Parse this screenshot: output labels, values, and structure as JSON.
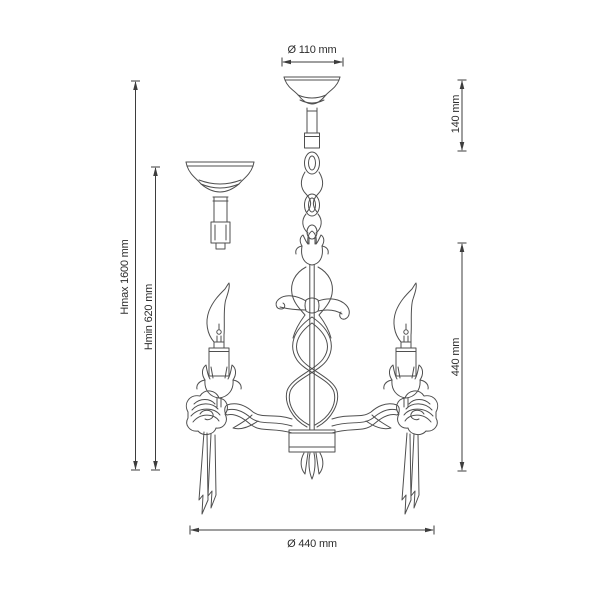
{
  "page": {
    "background": "#ffffff",
    "line_color": "#4f4f4f",
    "dimension_color": "#3d3d3d",
    "text_color": "#2d2d2d"
  },
  "drawing": {
    "parts": [
      "ceiling-canopy",
      "hanging-chain",
      "flush-mount-canopy",
      "ornate-center-column",
      "ribbon-bow",
      "twisted-helix-stem",
      "hub-cylinder",
      "leaf-finial",
      "left-arm",
      "right-arm",
      "candle-bulbs",
      "tulip-bobeches",
      "rose-ornaments",
      "ribbon-tails"
    ]
  },
  "dimensions": [
    {
      "name": "canopy-diameter",
      "label": "Ø 110 mm",
      "value_mm": 110,
      "type": "diameter",
      "orientation": "horizontal"
    },
    {
      "name": "canopy-height",
      "label": "140 mm",
      "value_mm": 140,
      "type": "height",
      "orientation": "vertical"
    },
    {
      "name": "max-height",
      "label": "Hmax 1600 mm",
      "value_mm": 1600,
      "type": "height",
      "orientation": "vertical"
    },
    {
      "name": "min-height",
      "label": "Hmin 620 mm",
      "value_mm": 620,
      "type": "height",
      "orientation": "vertical"
    },
    {
      "name": "fixture-height",
      "label": "440 mm",
      "value_mm": 440,
      "type": "height",
      "orientation": "vertical"
    },
    {
      "name": "fixture-diameter",
      "label": "Ø 440 mm",
      "value_mm": 440,
      "type": "diameter",
      "orientation": "horizontal"
    }
  ]
}
